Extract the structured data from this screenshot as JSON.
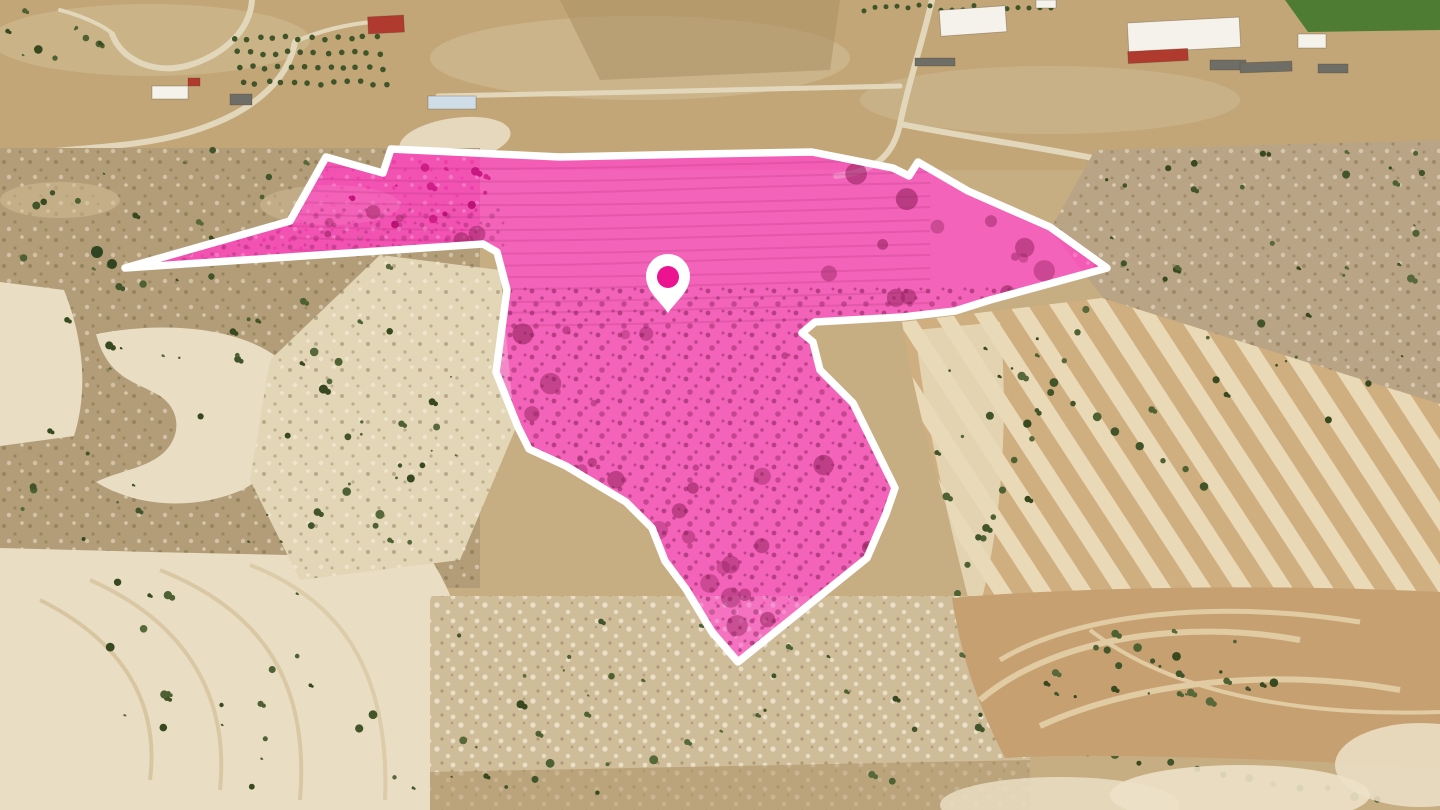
{
  "parcel": {
    "fill_color": "#e5309e",
    "fill_opacity": 0.38,
    "outline_color": "#ffffff",
    "outline_width": 7.5,
    "points": [
      [
        125,
        268
      ],
      [
        290,
        221
      ],
      [
        326,
        157
      ],
      [
        383,
        173
      ],
      [
        391,
        149
      ],
      [
        560,
        157
      ],
      [
        700,
        154
      ],
      [
        812,
        152
      ],
      [
        893,
        168
      ],
      [
        909,
        176
      ],
      [
        918,
        162
      ],
      [
        968,
        191
      ],
      [
        1050,
        227
      ],
      [
        1107,
        268
      ],
      [
        990,
        300
      ],
      [
        955,
        311
      ],
      [
        903,
        317
      ],
      [
        815,
        322
      ],
      [
        802,
        333
      ],
      [
        813,
        342
      ],
      [
        820,
        370
      ],
      [
        853,
        403
      ],
      [
        895,
        488
      ],
      [
        886,
        514
      ],
      [
        867,
        558
      ],
      [
        738,
        662
      ],
      [
        712,
        632
      ],
      [
        686,
        589
      ],
      [
        665,
        561
      ],
      [
        652,
        528
      ],
      [
        626,
        502
      ],
      [
        566,
        466
      ],
      [
        529,
        449
      ],
      [
        518,
        427
      ],
      [
        496,
        372
      ],
      [
        507,
        290
      ],
      [
        497,
        252
      ],
      [
        483,
        244
      ]
    ]
  },
  "marker": {
    "cx": 668,
    "cy": 276,
    "r": 22,
    "tip_y": 313,
    "pin_color": "#ffffff",
    "dot_color": "#ec1390",
    "dot_r": 11
  },
  "palette": {
    "terrain_base": "#c7ad82",
    "hills_top": "#c2a678",
    "hill_shade": "#d3bf98",
    "field_light": "#e9dec3",
    "field_tan": "#c7a072",
    "scrub_left": "#b29d78",
    "scrub_right": "#b9a585",
    "scrub_bottom": "#cfbd9a",
    "hill_center": "#e3d6b7",
    "field_stripe_dark": "#cfae7f",
    "field_stripe_light": "#ead9b6",
    "field_stripe_pale": "#e8d9b8",
    "crop_green": "#4e7c33",
    "vegetation_dark": "#3f5429",
    "road": "#e2d7ba",
    "roof_red": "#b03a2e",
    "roof_white": "#f4f2ea",
    "roof_blue": "#cfdde8",
    "shed_grey": "#6e6e66",
    "dirt_brown": "#ac8f63",
    "swirl_light": "#e6d3ab",
    "pale_patch": "#ece1c8",
    "parcel_scrub_dark": "#7a1b50",
    "parcel_row_line": "#8e1a5c",
    "parcel_blob": "#8f1f5a"
  }
}
